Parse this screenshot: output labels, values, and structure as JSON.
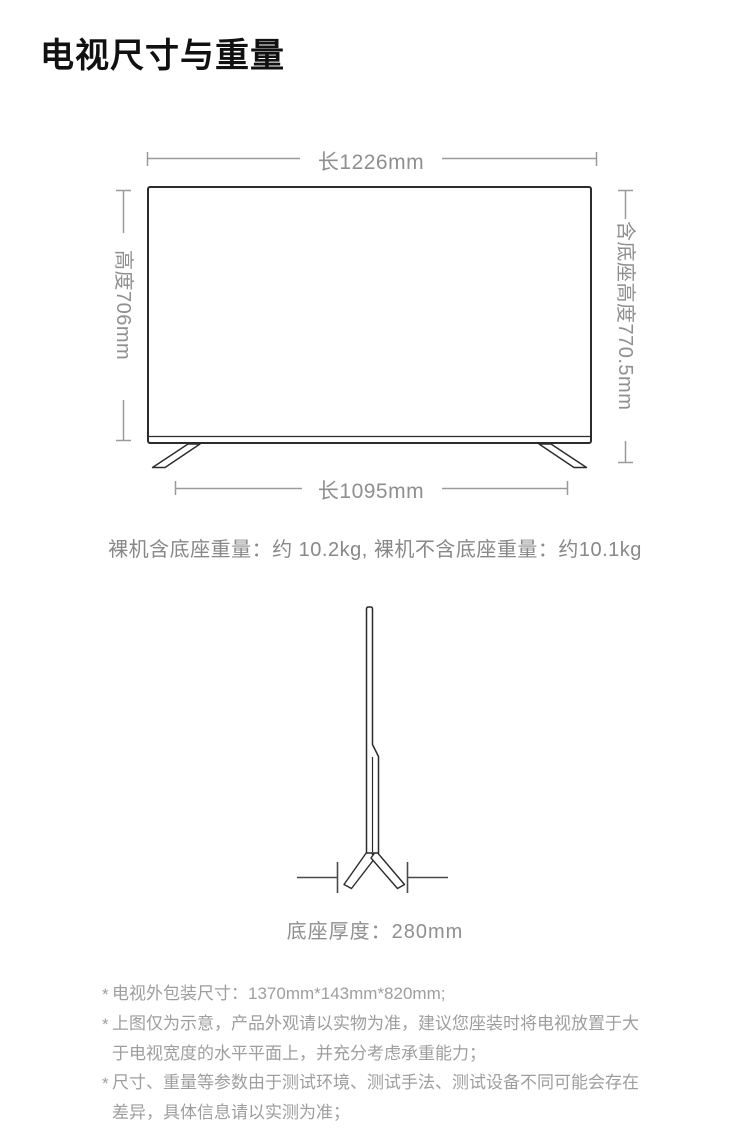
{
  "title": "电视尺寸与重量",
  "front_view": {
    "top_dimension": "长1226mm",
    "left_dimension": "高度706mm",
    "right_dimension": "含底座高度770.5mm",
    "bottom_dimension": "长1095mm"
  },
  "weight_note": "裸机含底座重量：约 10.2kg, 裸机不含底座重量：约10.1kg",
  "side_view": {
    "base_thickness_note": "底座厚度：280mm"
  },
  "footnote_marker": "*",
  "footnotes": [
    "电视外包装尺寸：1370mm*143mm*820mm;",
    "上图仅为示意，产品外观请以实物为准，建议您座装时将电视放置于大于电视宽度的水平平面上，并充分考虑承重能力；",
    "尺寸、重量等参数由于测试环境、测试手法、测试设备不同可能会存在差异，具体信息请以实测为准；"
  ],
  "colors": {
    "background": "#ffffff",
    "title_text": "#111111",
    "outline": "#2b2b2b",
    "dimension_lines": "#9a9a9a",
    "dimension_text": "#8f8f8f",
    "body_text": "#888888",
    "footnote_text": "#9e9e9e"
  }
}
